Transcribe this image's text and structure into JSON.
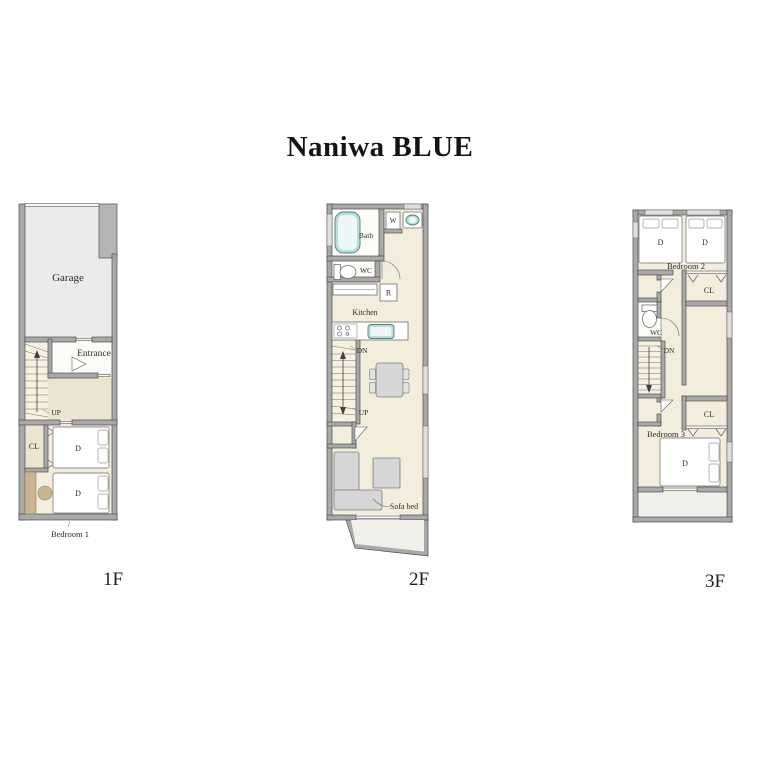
{
  "title": "Naniwa BLUE",
  "floors": {
    "f1": {
      "name": "1F",
      "labels": {
        "garage": "Garage",
        "entrance": "Entrance",
        "up": "UP",
        "closet": "CL",
        "bed1": "D",
        "bed2": "D",
        "bedroom": "Bedroom 1"
      }
    },
    "f2": {
      "name": "2F",
      "labels": {
        "bath": "Bath",
        "washer": "W",
        "wc": "WC",
        "fridge": "R",
        "kitchen": "Kitchen",
        "down": "DN",
        "up": "UP",
        "sofa_bed": "Sofa bed"
      }
    },
    "f3": {
      "name": "3F",
      "labels": {
        "bedroom2": "Bedroom 2",
        "bed1": "D",
        "bed2": "D",
        "closet_upper": "CL",
        "wc": "WC",
        "down": "DN",
        "closet_lower": "CL",
        "bedroom3": "Bedroom 3",
        "bed3": "D"
      }
    }
  },
  "colors": {
    "wall": "#a9a9a9",
    "wall_outline": "#4f4f4f",
    "floor_cream": "#f3edde",
    "floor_white": "#fbfbf7",
    "floor_garage": "#ebebeb",
    "floor_hall": "#ebe4d1",
    "floor_balcony": "#f1f0ea",
    "fixture_teal": "#b9dcd7",
    "furniture_gray": "#d6d6d6",
    "wood_tan": "#c9b590",
    "text": "#2d2d2d"
  }
}
